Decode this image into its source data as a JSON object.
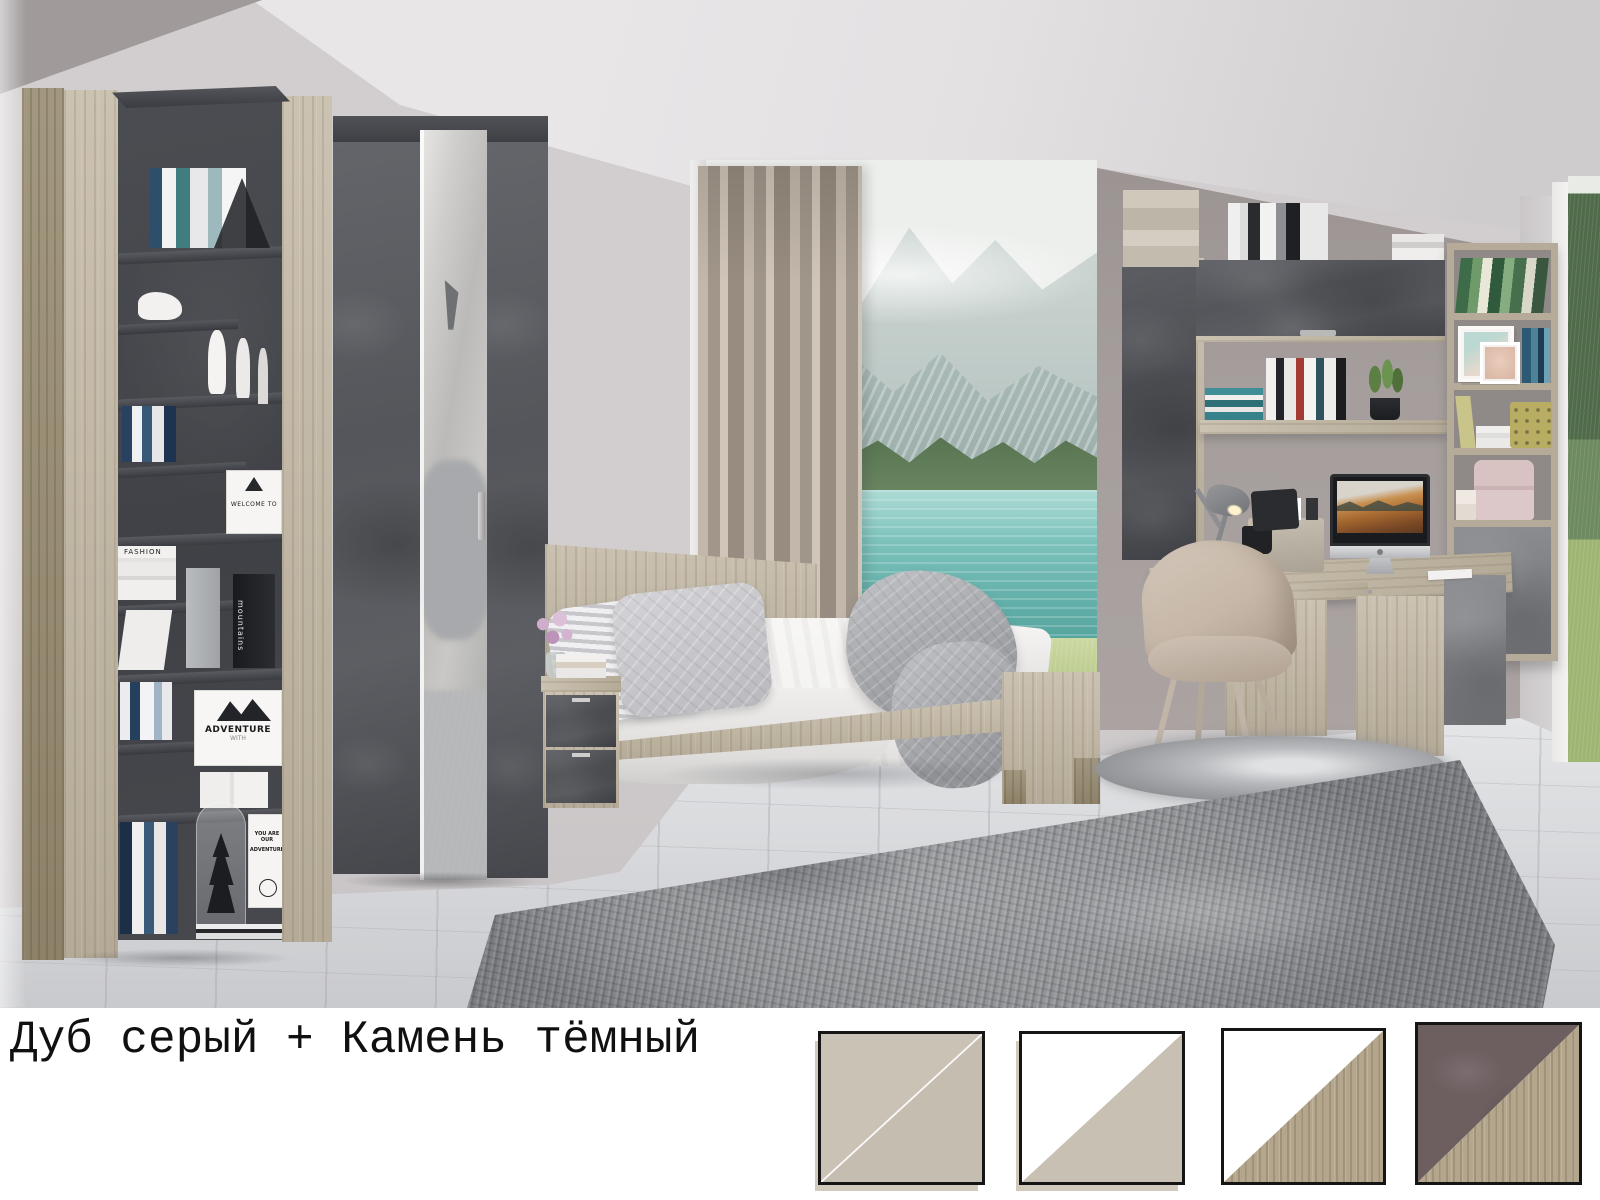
{
  "caption": {
    "text": "Дуб серый + Камень тёмный"
  },
  "palette": {
    "wall": "#d2cecf",
    "wall-dark": "#a09a9b",
    "ceiling": "#e3e1e2",
    "alcove": "#a59e9c",
    "floor": "#d6d7da",
    "oak": "#b4aa97",
    "oak-light": "#cbc2b2",
    "concrete": "#54565b",
    "concrete-dark": "#45474c",
    "rug": "#939497",
    "blanket": "#a4a5a9",
    "curtain": "#b4a99c",
    "curtain-dark": "#a1968a",
    "lake": "#64b0aa",
    "grass": "#b4c687",
    "forest": "#55714f",
    "mountain": "#bcc8c5",
    "sky": "#edefed",
    "chair": "#c6b7a8",
    "bedding": "#f4f3f1",
    "pink-box": "#d8c2c2",
    "swatch-border": "#151515"
  },
  "scene": {
    "description": "Teen bedroom furniture set in grey oak and dark concrete-stone decor: corner bookshelf, mirrored wardrobe, bed with nightstand, wall shelving and corner desk with iMac, shaggy rugs, panoramic window with mountain lake view",
    "decor": {
      "adventure_sign": "ADVENTURE",
      "adventure_sign_sub": "WITH",
      "you_card_line1": "YOU ARE OUR",
      "you_card_line2": "ADVENTURE",
      "mountains_book": "mountains",
      "fashion_book": "FASHION",
      "welcome_card": "WELCOME TO"
    }
  },
  "swatches": [
    {
      "position": 1,
      "top_left": {
        "material": "beige",
        "hex": "#c9c2b5",
        "texture": "plain"
      },
      "bottom_right": {
        "material": "beige",
        "hex": "#c4bdb0",
        "texture": "plain"
      },
      "divider_line": "white"
    },
    {
      "position": 2,
      "top_left": {
        "material": "white",
        "hex": "#ffffff",
        "texture": "plain"
      },
      "bottom_right": {
        "material": "beige",
        "hex": "#c7c0b3",
        "texture": "plain"
      }
    },
    {
      "position": 3,
      "top_left": {
        "material": "white",
        "hex": "#ffffff",
        "texture": "plain"
      },
      "bottom_right": {
        "material": "grey oak",
        "hex": "#b3a68d",
        "texture": "wood"
      }
    },
    {
      "position": 4,
      "top_left": {
        "material": "dark stone",
        "hex": "#6d5e60",
        "texture": "stone"
      },
      "bottom_right": {
        "material": "grey oak",
        "hex": "#b3a68d",
        "texture": "wood"
      }
    }
  ]
}
